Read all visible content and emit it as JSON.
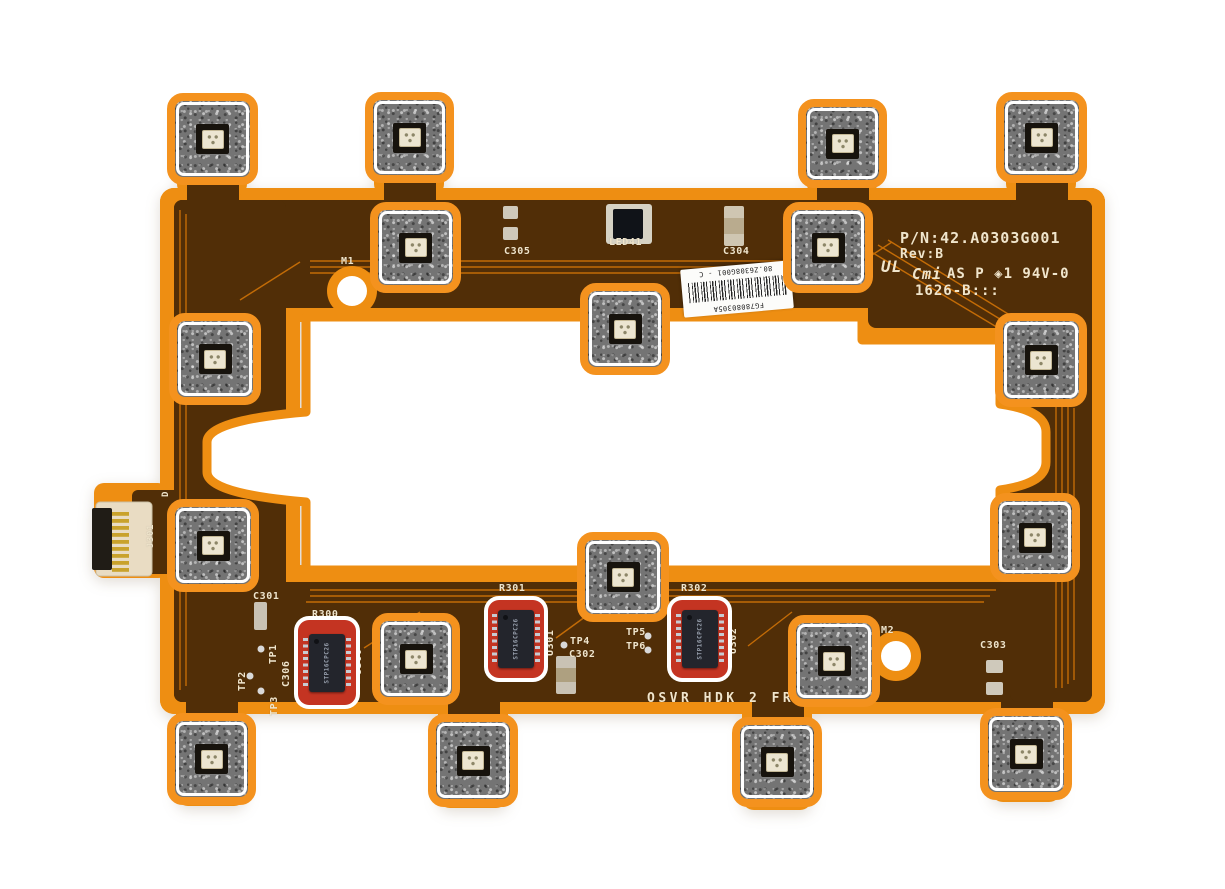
{
  "image_type": "photograph of OSVR HDK 2 front flexible LED circuit board with annotation markers",
  "colors": {
    "background": "#ffffff",
    "flex_orange": "#ee8e12",
    "copper_dark": "#512e07",
    "trace_orange": "#c96f06",
    "marker_orange": "#f4921e",
    "marker_red": "#c43422",
    "marker_white": "#ffffff",
    "silkscreen": "#f0e5cc"
  },
  "board": {
    "part_number_block": {
      "part_number": "P/N:42.A0303G001",
      "revision": "Rev:B",
      "ul_mark": "UL",
      "manufacturer_mark": "Cmi",
      "cert_line": "AS P ◈1 94V-0",
      "date_code": "1626-B:::"
    },
    "barcode_label": {
      "serial": "FG78080305A",
      "part_code": "80.Z6308G001 - C"
    },
    "silkscreen_labels": [
      {
        "name": "label-c305",
        "text": "C305",
        "x": 504,
        "y": 246
      },
      {
        "name": "label-led41",
        "text": "LED41",
        "x": 609,
        "y": 237
      },
      {
        "name": "label-c304",
        "text": "C304",
        "x": 723,
        "y": 246
      },
      {
        "name": "label-m1",
        "text": "M1",
        "x": 341,
        "y": 256
      },
      {
        "name": "label-c301",
        "text": "C301",
        "x": 253,
        "y": 591
      },
      {
        "name": "label-r300",
        "text": "R300",
        "x": 312,
        "y": 609
      },
      {
        "name": "label-tp1",
        "text": "TP1",
        "x": 268,
        "y": 664,
        "rot": -90
      },
      {
        "name": "label-c306",
        "text": "C306",
        "x": 281,
        "y": 687,
        "rot": -90
      },
      {
        "name": "label-tp2",
        "text": "TP2",
        "x": 237,
        "y": 691,
        "rot": -90
      },
      {
        "name": "label-tp3",
        "text": "TP3",
        "x": 269,
        "y": 716,
        "rot": -90
      },
      {
        "name": "label-u300",
        "text": "U300",
        "x": 353,
        "y": 675,
        "rot": -90
      },
      {
        "name": "label-r301",
        "text": "R301",
        "x": 499,
        "y": 583
      },
      {
        "name": "label-u301",
        "text": "U301",
        "x": 545,
        "y": 656,
        "rot": -90
      },
      {
        "name": "label-tp4",
        "text": "TP4",
        "x": 570,
        "y": 636
      },
      {
        "name": "label-c302",
        "text": "C302",
        "x": 569,
        "y": 649
      },
      {
        "name": "label-r302",
        "text": "R302",
        "x": 681,
        "y": 583
      },
      {
        "name": "label-u302",
        "text": "U302",
        "x": 728,
        "y": 654,
        "rot": -90
      },
      {
        "name": "label-tp5",
        "text": "TP5",
        "x": 626,
        "y": 627
      },
      {
        "name": "label-tp6",
        "text": "TP6",
        "x": 626,
        "y": 641
      },
      {
        "name": "label-m2",
        "text": "M2",
        "x": 881,
        "y": 625
      },
      {
        "name": "label-c303",
        "text": "C303",
        "x": 980,
        "y": 640
      },
      {
        "name": "label-j301",
        "text": "J301",
        "x": 146,
        "y": 548,
        "rot": -90,
        "size": 9
      },
      {
        "name": "label-d",
        "text": "D",
        "x": 161,
        "y": 497,
        "rot": -90,
        "size": 9
      },
      {
        "name": "label-board-title",
        "text": "OSVR HDK 2 FRONT",
        "x": 647,
        "y": 691,
        "size": 13,
        "ls": 3.5
      }
    ]
  },
  "markers": {
    "led_boxes": [
      {
        "id": "led-marker-1",
        "x": 167,
        "y": 93,
        "w": 91,
        "h": 92
      },
      {
        "id": "led-marker-2",
        "x": 365,
        "y": 92,
        "w": 89,
        "h": 91
      },
      {
        "id": "led-marker-3",
        "x": 798,
        "y": 99,
        "w": 89,
        "h": 89
      },
      {
        "id": "led-marker-4",
        "x": 996,
        "y": 92,
        "w": 91,
        "h": 91
      },
      {
        "id": "led-marker-5",
        "x": 370,
        "y": 202,
        "w": 91,
        "h": 91
      },
      {
        "id": "led-marker-6",
        "x": 783,
        "y": 202,
        "w": 90,
        "h": 91
      },
      {
        "id": "led-marker-7",
        "x": 580,
        "y": 283,
        "w": 90,
        "h": 92
      },
      {
        "id": "led-marker-8",
        "x": 169,
        "y": 313,
        "w": 92,
        "h": 92
      },
      {
        "id": "led-marker-9",
        "x": 167,
        "y": 499,
        "w": 92,
        "h": 93
      },
      {
        "id": "led-marker-10",
        "x": 995,
        "y": 313,
        "w": 92,
        "h": 94
      },
      {
        "id": "led-marker-11",
        "x": 990,
        "y": 493,
        "w": 90,
        "h": 89
      },
      {
        "id": "led-marker-12",
        "x": 577,
        "y": 532,
        "w": 92,
        "h": 90
      },
      {
        "id": "led-marker-13",
        "x": 372,
        "y": 613,
        "w": 88,
        "h": 92
      },
      {
        "id": "led-marker-14",
        "x": 788,
        "y": 615,
        "w": 92,
        "h": 92
      },
      {
        "id": "led-marker-15",
        "x": 167,
        "y": 713,
        "w": 89,
        "h": 92
      },
      {
        "id": "led-marker-16",
        "x": 428,
        "y": 714,
        "w": 90,
        "h": 93
      },
      {
        "id": "led-marker-17",
        "x": 732,
        "y": 717,
        "w": 90,
        "h": 90
      },
      {
        "id": "led-marker-18",
        "x": 980,
        "y": 708,
        "w": 92,
        "h": 92
      }
    ],
    "ic_boxes": [
      {
        "id": "ic-marker-u300",
        "x": 298,
        "y": 620,
        "w": 58,
        "h": 85,
        "chip_marking": "STP16CPC26"
      },
      {
        "id": "ic-marker-u301",
        "x": 488,
        "y": 600,
        "w": 56,
        "h": 78,
        "chip_marking": "STP16CPC26"
      },
      {
        "id": "ic-marker-u302",
        "x": 671,
        "y": 600,
        "w": 57,
        "h": 78,
        "chip_marking": "STP16CPC26"
      }
    ]
  }
}
